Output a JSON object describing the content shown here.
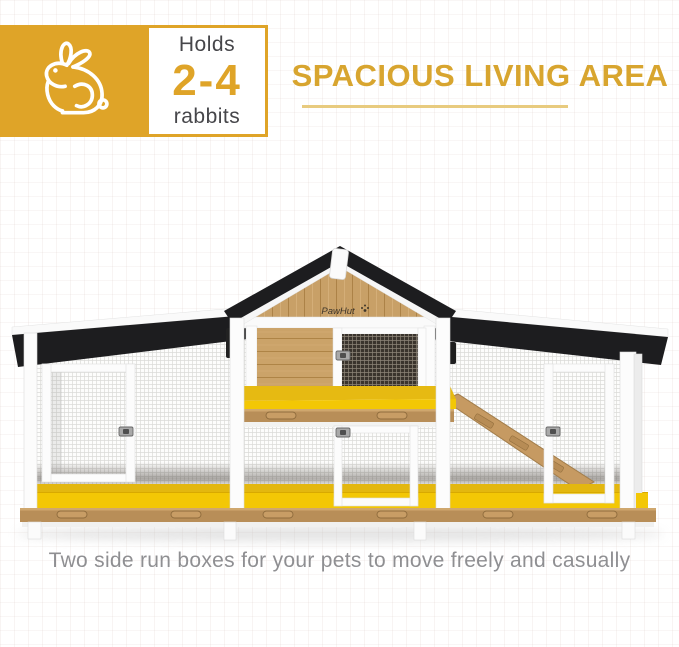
{
  "badge": {
    "icon": "rabbit-icon",
    "holds_label": "Holds",
    "capacity": "2-4",
    "rabbits_label": "rabbits",
    "box_color": "#DFA428"
  },
  "heading": {
    "title": "SPACIOUS LIVING AREA",
    "color": "#D8A52F",
    "underline_color": "#E8CB7F"
  },
  "product": {
    "brand": "PawHut",
    "description": "wooden rabbit hutch with black roof, two side run boxes and yellow pull-out trays"
  },
  "caption": {
    "text": "Two side run boxes for your pets to move freely and casually"
  },
  "colors": {
    "accent_amber": "#DFA428",
    "tray_yellow": "#F3C704",
    "roof_black": "#1D1D1F",
    "wood": "#C49A63",
    "text_dark": "#46464A",
    "caption_gray": "#8F8F92"
  }
}
